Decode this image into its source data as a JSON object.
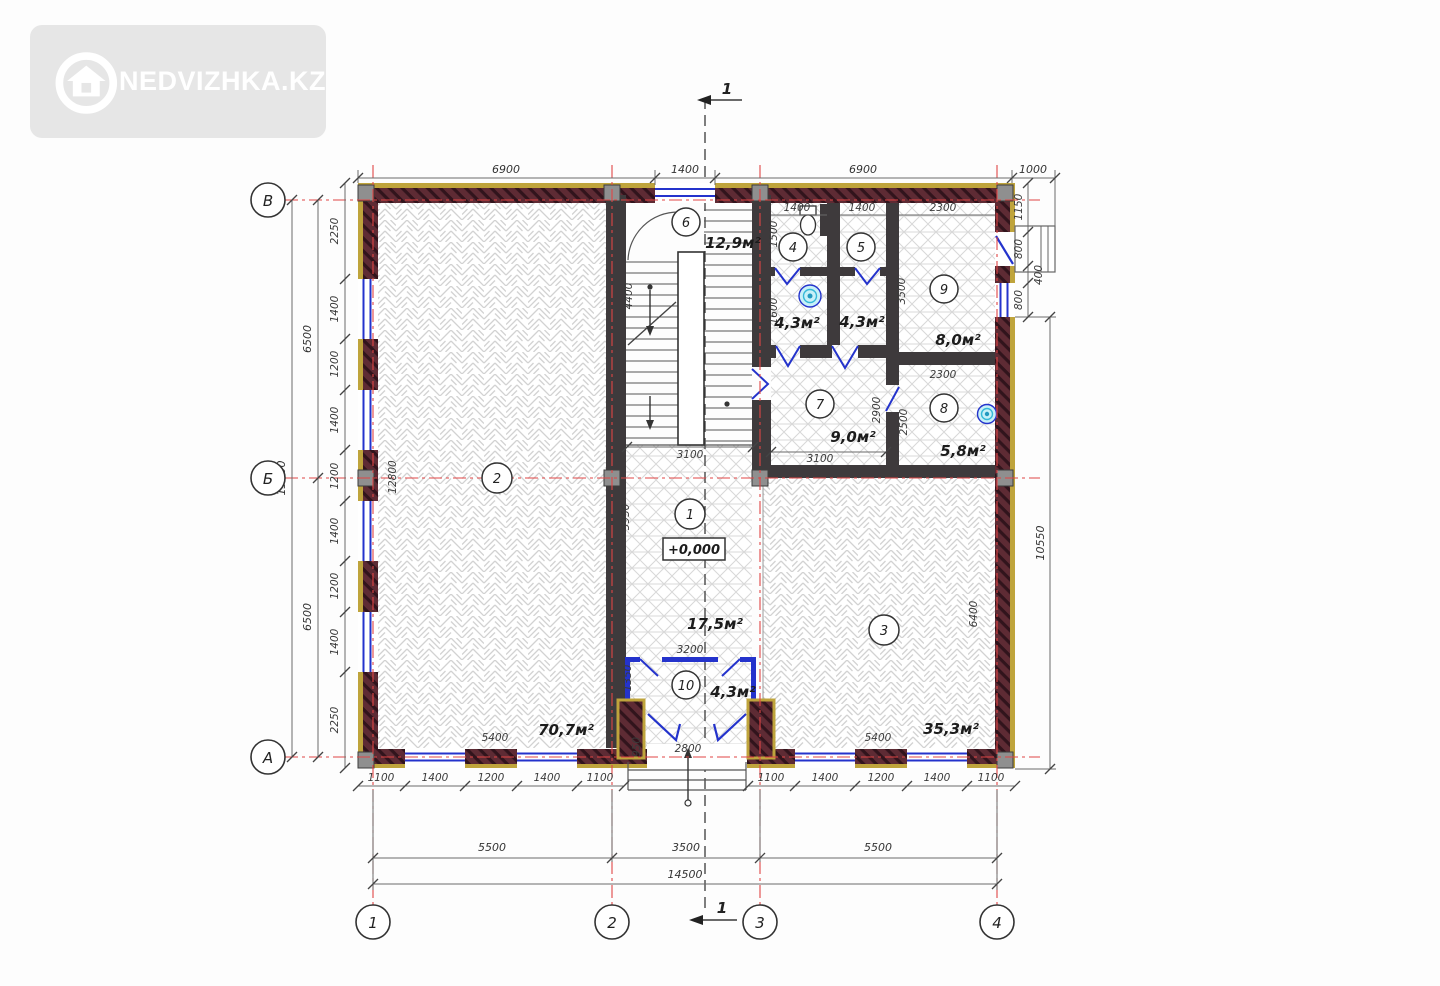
{
  "watermark": {
    "brand": "NEDVIZHKA.KZ",
    "icon": "house-icon"
  },
  "plan": {
    "section_label": "1",
    "elevation": "+0,000",
    "axes": {
      "rows": [
        "В",
        "Б",
        "А"
      ],
      "cols": [
        "1",
        "2",
        "3",
        "4"
      ]
    },
    "rooms": [
      {
        "number": "1",
        "area": "17,5м²"
      },
      {
        "number": "2",
        "area": "70,7м²"
      },
      {
        "number": "3",
        "area": "35,3м²"
      },
      {
        "number": "4",
        "area": "4,3м²"
      },
      {
        "number": "5",
        "area": "4,3м²"
      },
      {
        "number": "6",
        "area": "12,9м²"
      },
      {
        "number": "7",
        "area": "9,0м²"
      },
      {
        "number": "8",
        "area": "5,8м²"
      },
      {
        "number": "9",
        "area": "8,0м²"
      },
      {
        "number": "10",
        "area": "4,3м²"
      }
    ],
    "dims": {
      "top": [
        "6900",
        "1400",
        "6900",
        "1000"
      ],
      "bottom_chain": [
        "1100",
        "1400",
        "1200",
        "1400",
        "1100"
      ],
      "bottom_spans": [
        "5500",
        "3500",
        "5500"
      ],
      "total_width": "14500",
      "left_chain": [
        "2250",
        "1400",
        "1200",
        "1400",
        "1200",
        "1400",
        "1200",
        "1400",
        "2250"
      ],
      "left_spans": [
        "6500",
        "6500"
      ],
      "total_height": "13000",
      "right_chain": [
        "1150",
        "800",
        "400",
        "800"
      ],
      "right_span": "10550",
      "porch": {
        "width": "2800",
        "depth": "950"
      },
      "interior": {
        "room2_width": "5400",
        "room2_height": "12800",
        "room3_width": "5400",
        "room3_height": "6400",
        "hall_height": "5950",
        "vestibule_width": "3200",
        "vestibule_height": "1350",
        "stairs_height": "4400",
        "stairs_width": "3100",
        "room4_width": "1400",
        "room5_width": "1400",
        "room45_depth1": "1500",
        "room45_depth2": "1600",
        "room9_width": "2300",
        "room9_height": "3500",
        "room7_width": "3100",
        "room7_height": "2900",
        "room8_width": "2300",
        "room8_height": "2500"
      }
    },
    "colors": {
      "wall": "#5e2b34",
      "insulation": "#bfa43c",
      "window": "#2433cc",
      "axis": "#e04545",
      "fixture": "#45c8e6"
    }
  }
}
